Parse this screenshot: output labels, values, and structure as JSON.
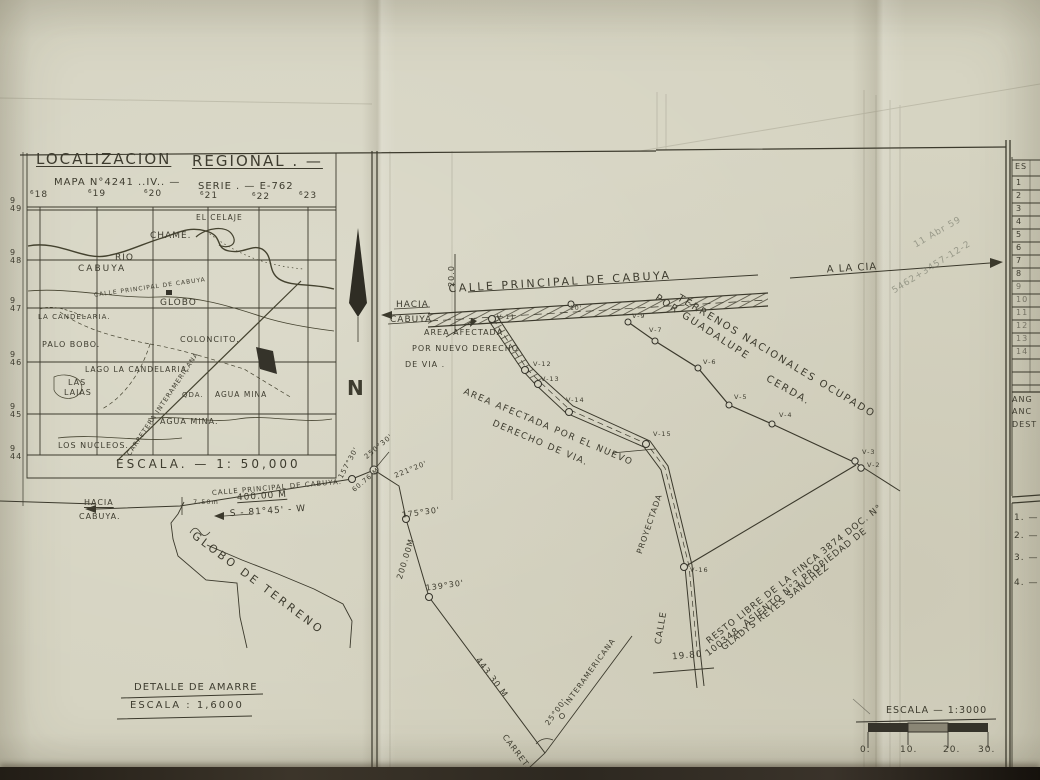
{
  "inset": {
    "title_left": "LOCALIZACION",
    "title_right": "REGIONAL . —",
    "map_no": "MAPA N°4241 ..IV.. —",
    "serie": "SERIE . — E-762",
    "grid_cols": [
      "⁶18",
      "⁶19",
      "⁶20",
      "⁶21",
      "⁶22",
      "⁶23"
    ],
    "grid_rows": [
      {
        "a": "9",
        "b": "49"
      },
      {
        "a": "9",
        "b": "48"
      },
      {
        "a": "9",
        "b": "47"
      },
      {
        "a": "9",
        "b": "46"
      },
      {
        "a": "9",
        "b": "45"
      },
      {
        "a": "9",
        "b": "44"
      }
    ],
    "places": {
      "el_celaje": "EL CELAJE",
      "chame": "CHAME.",
      "rio": "RIO",
      "cabuya": "CABUYA",
      "calle_ppal": "CALLE PRINCIPAL DE CABUYA",
      "globo": "GLOBO",
      "coloncito": "COLONCITO.",
      "la_candelaria": "LA CANDELARIA.",
      "palo_bobo": "PALO BOBO.",
      "lago_candelaria": "LAGO LA CANDELARIA.",
      "las": "LAS",
      "lajas": "LAJAS",
      "qda": "QDA.",
      "agua_mina_1": "AGUA MINA",
      "agua_mina_2": "AGUA MINA.",
      "los_nucleos": "LOS NUCLEOS.",
      "carretera": "CARRETERA INTERAMERICANA"
    },
    "scale": "ESCALA. — 1: 50,000"
  },
  "north_label": "N",
  "plan": {
    "calle_principal": "CALLE PRINCIPAL DE CABUYA",
    "a_la_cia": "A LA CIA",
    "hacia": "HACIA",
    "cabuya": "CABUYA",
    "width_20": "20.0",
    "dist_10": "10'",
    "area1_l1": "AREA AFECTADA",
    "area1_l2": "POR NUEVO DERECHO",
    "area1_l3": "DE VIA .",
    "area2_l1": "AREA AFECTADA POR EL NUEVO",
    "area2_l2": "DERECHO DE VIA.",
    "terrenos": "TERRENOS NACIONALES OCUPADO",
    "por_guadalupe": "POR GUADALUPE",
    "cerda": "CERDA.",
    "resto_l1": "RESTO LIBRE DE LA FINCA 3874 DOC. N°",
    "resto_l2": "100348, ASIENTO N°3 PROPIEDAD DE",
    "resto_l3": "GLADYS REYES SANCHEZ",
    "proyectada": "PROYECTADA",
    "calle": "CALLE",
    "dist_1980": "19.80",
    "vertices": {
      "v2": "V-2",
      "v3": "V-3",
      "v4": "V-4",
      "v5": "V-5",
      "v6": "V-6",
      "v7": "V-7",
      "v9": "V-9",
      "v11": "V-11",
      "v12": "V-12",
      "v13": "V-13",
      "v14": "V-14",
      "v15": "V-15",
      "v16": "V-16"
    }
  },
  "detail": {
    "hacia": "HACIA",
    "cabuya": "CABUYA.",
    "calle_principal": "CALLE PRINCIPAL DE CABUYA.",
    "m_750": "7.50m",
    "m_400": "400.00 M",
    "bearing": "S - 81°45' - W",
    "ang_157": "157°30'",
    "ang_250": "250°30'",
    "m_6076": "60.76 M",
    "ang_221": "221°20'",
    "ang_175": "175°30'",
    "m_200": "200.00M",
    "ang_139": "139°30'",
    "m_443": "443.30 M",
    "carret": "CARRET.",
    "ang_25": "25°00'",
    "interamericana": "INTERAMERICANA",
    "globo_de_terreno": "GLOBO DE TERRENO",
    "title": "DETALLE DE AMARRE",
    "scale": "ESCALA : 1,6000"
  },
  "scalebar": {
    "label": "ESCALA — 1:3000",
    "ticks": [
      "0.",
      "10.",
      "20.",
      "30."
    ]
  },
  "side": {
    "header": "ES",
    "rows": [
      "1",
      "2",
      "3",
      "4",
      "5",
      "6",
      "7",
      "8",
      "9",
      "10",
      "11",
      "12",
      "13",
      "14"
    ],
    "notes": [
      "ANG",
      "ANC",
      "DEST"
    ],
    "list": [
      "1. —",
      "2. —",
      "3. —",
      "4. —"
    ]
  },
  "annotations": {
    "pencil_1": "11 Abr 59",
    "pencil_2": "5462+3457-12-2"
  }
}
